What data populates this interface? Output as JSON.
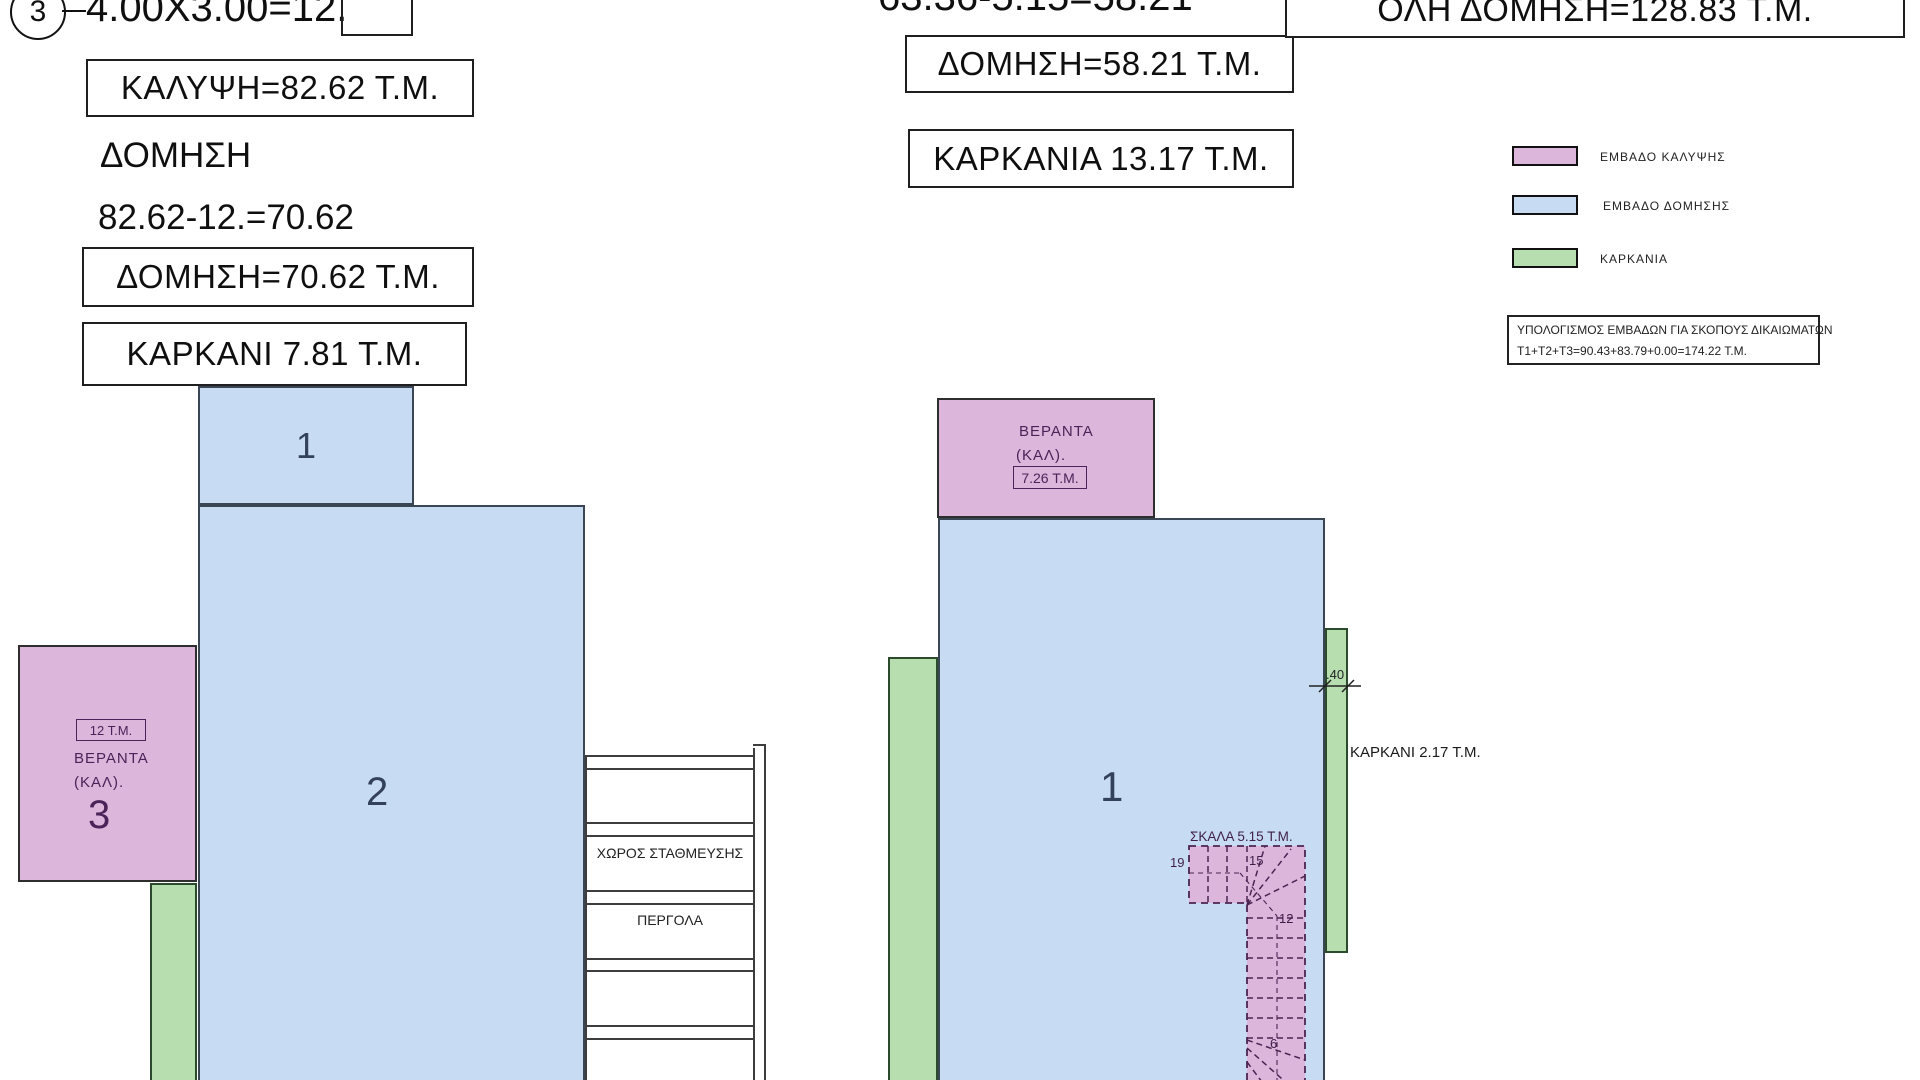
{
  "sheet": {
    "type": "architectural-area-plan"
  },
  "colors": {
    "kalypsi_pink": "#dcb6db",
    "domisi_blue": "#c7dcf2",
    "karkania_green": "#b7deae",
    "ink": "#0f0f0f",
    "plan_number_ink": "#33415a",
    "pink_ink": "#4a2458"
  },
  "left_calcs": {
    "badge": "3",
    "formula": "4.00X3.00=12.",
    "kalypsi": "ΚΑΛΥΨΗ=82.62 Τ.Μ.",
    "domisi_title": "ΔΟΜΗΣΗ",
    "domisi_calc": "82.62-12.=70.62",
    "domisi_total": "ΔΟΜΗΣΗ=70.62 Τ.Μ.",
    "karkani": "ΚΑΡΚΑΝΙ  7.81 Τ.Μ."
  },
  "mid_calcs": {
    "formula": "63.36-5.15=58.21",
    "domisi_total": "ΔΟΜΗΣΗ=58.21 Τ.Μ.",
    "karkania": "ΚΑΡΚΑΝΙΑ 13.17 Τ.Μ."
  },
  "totals": {
    "oli_domisi": "ΟΛΗ ΔΟΜΗΣΗ=128.83 Τ.Μ."
  },
  "legend": {
    "items": [
      {
        "label": "ΕΜΒΑΔΟ  ΚΑΛΥΨΗΣ",
        "color": "#dcb6db"
      },
      {
        "label": "ΕΜΒΑΔΟ  ΔΟΜΗΣΗΣ",
        "color": "#c7dcf2"
      },
      {
        "label": "ΚΑΡΚΑΝΙΑ",
        "color": "#b7deae"
      }
    ]
  },
  "rights_note": {
    "line1": "ΥΠΟΛΟΓΙΣΜΟΣ ΕΜΒΑΔΩΝ ΓΙΑ ΣΚΟΠΟΥΣ ΔΙΚΑΙΩΜΑΤΩΝ",
    "line2": "Τ1+Τ2+Τ3=90.43+83.79+0.00=174.22 Τ.Μ."
  },
  "plan_left": {
    "label1": "1",
    "label2": "2",
    "label3": "3",
    "veranda_area": "12 Τ.Μ.",
    "veranda_line1": "ΒΕΡΑΝΤΑ",
    "veranda_line2": "(ΚΑΛ).",
    "parking": "ΧΩΡΟΣ ΣΤΑΘΜΕΥΣΗΣ",
    "pergola": "ΠΕΡΓΟΛΑ"
  },
  "plan_right": {
    "label1": "1",
    "veranda_line1": "ΒΕΡΑΝΤΑ",
    "veranda_line2": "(ΚΑΛ).",
    "veranda_area": "7.26 Τ.Μ.",
    "stairs_title": "ΣΚΑΛΑ 5.15 Τ.Μ.",
    "step_19": "19",
    "step_15": "15",
    "step_12": "12",
    "step_6": "6",
    "karkani": "ΚΑΡΚΑΝΙ  2.17 Τ.Μ.",
    "dim": ".40"
  }
}
